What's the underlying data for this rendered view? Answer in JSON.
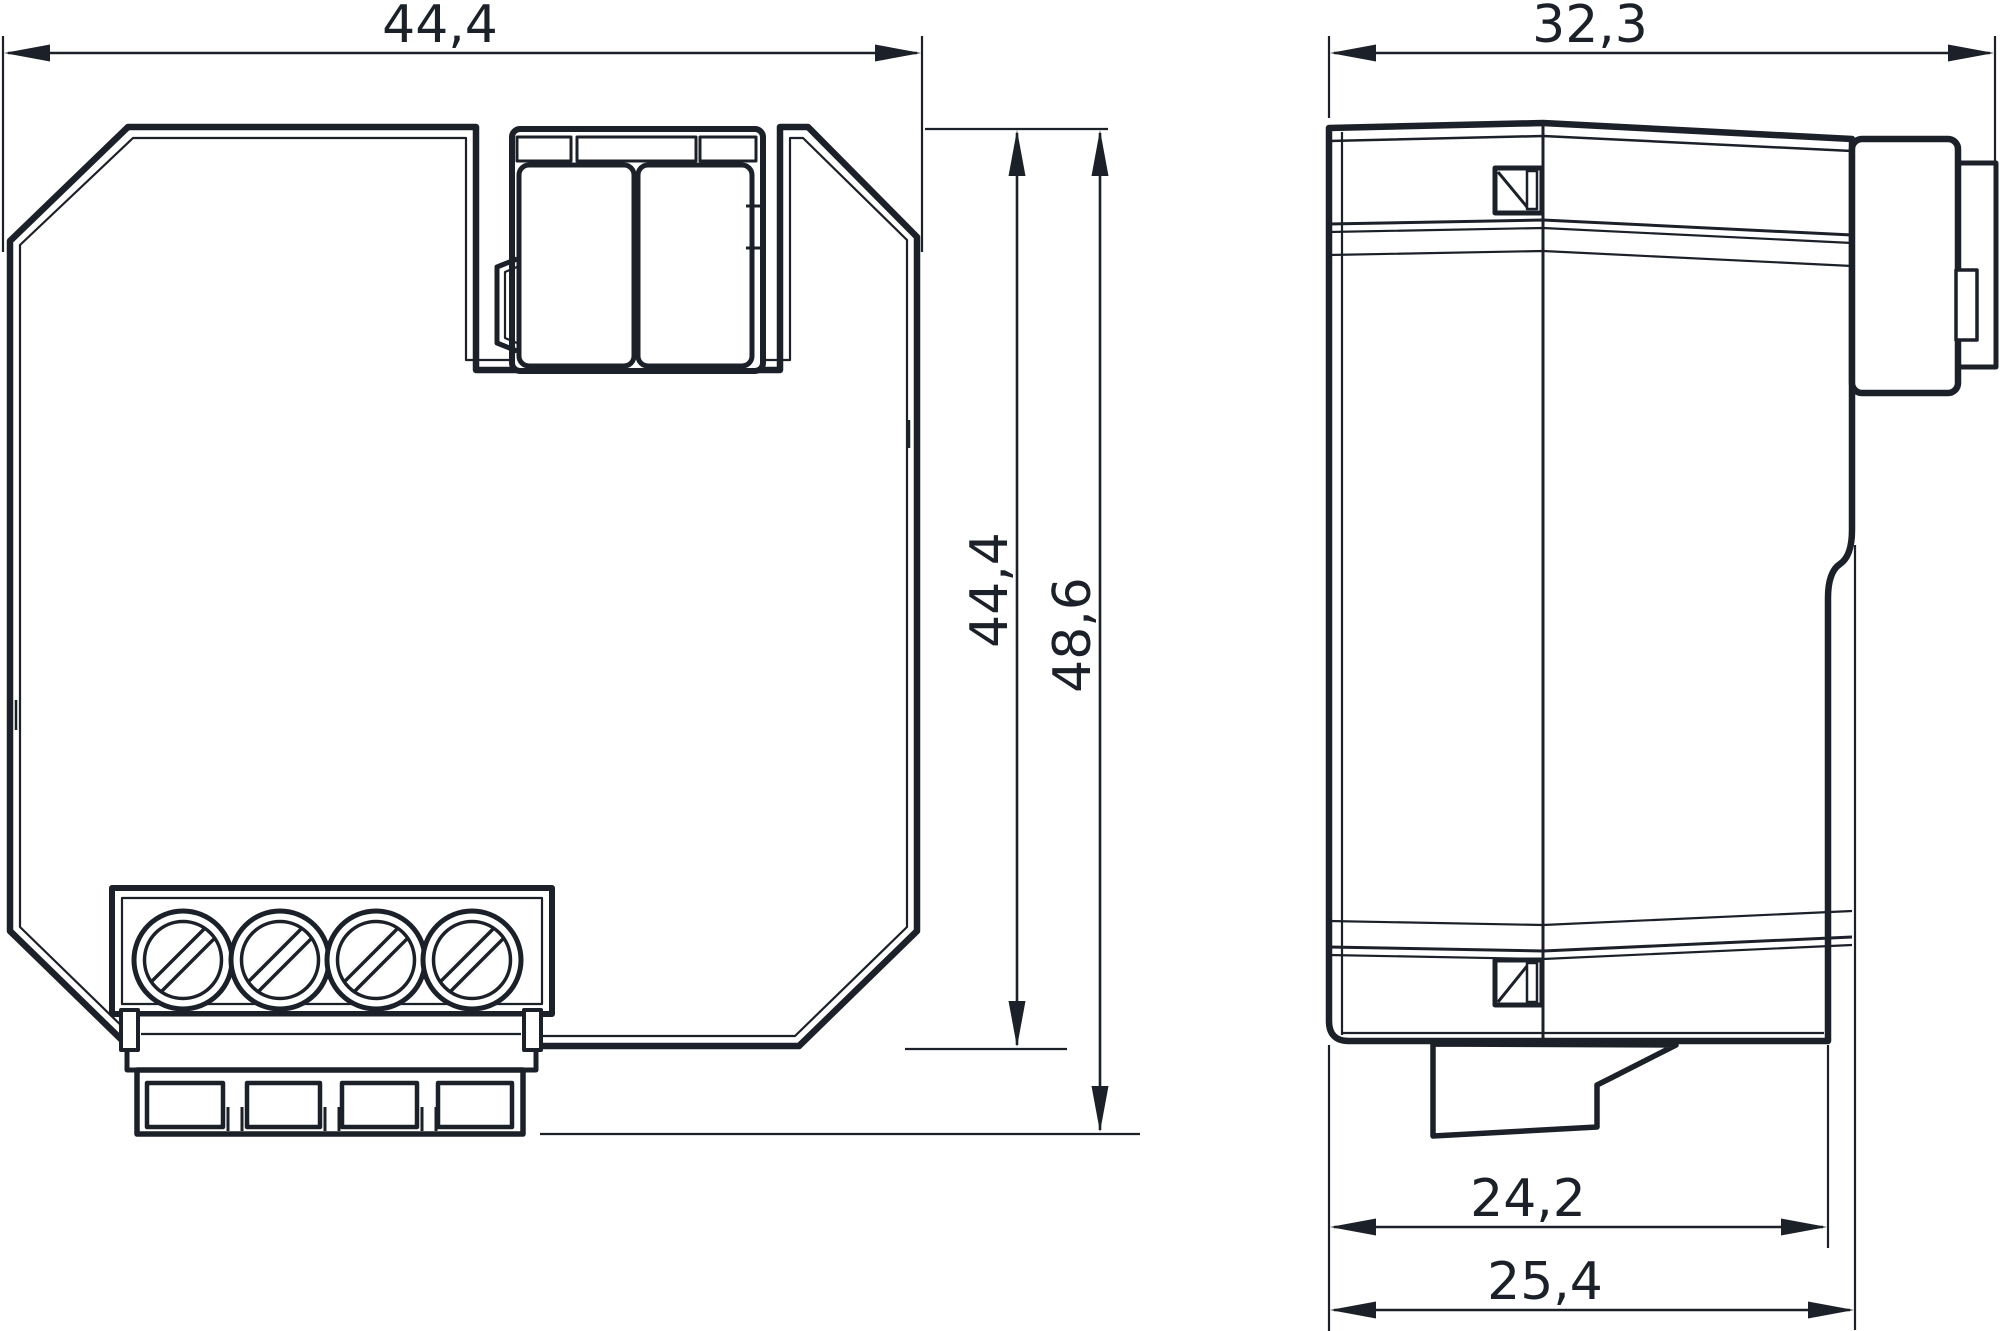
{
  "drawing": {
    "line_color": "#1c2028",
    "dimensions": {
      "front_width": "44,4",
      "front_body_height": "44,4",
      "front_total_height": "48,6",
      "side_total_depth": "32,3",
      "side_body_depth": "24,2",
      "side_flange_depth": "25,4"
    }
  }
}
